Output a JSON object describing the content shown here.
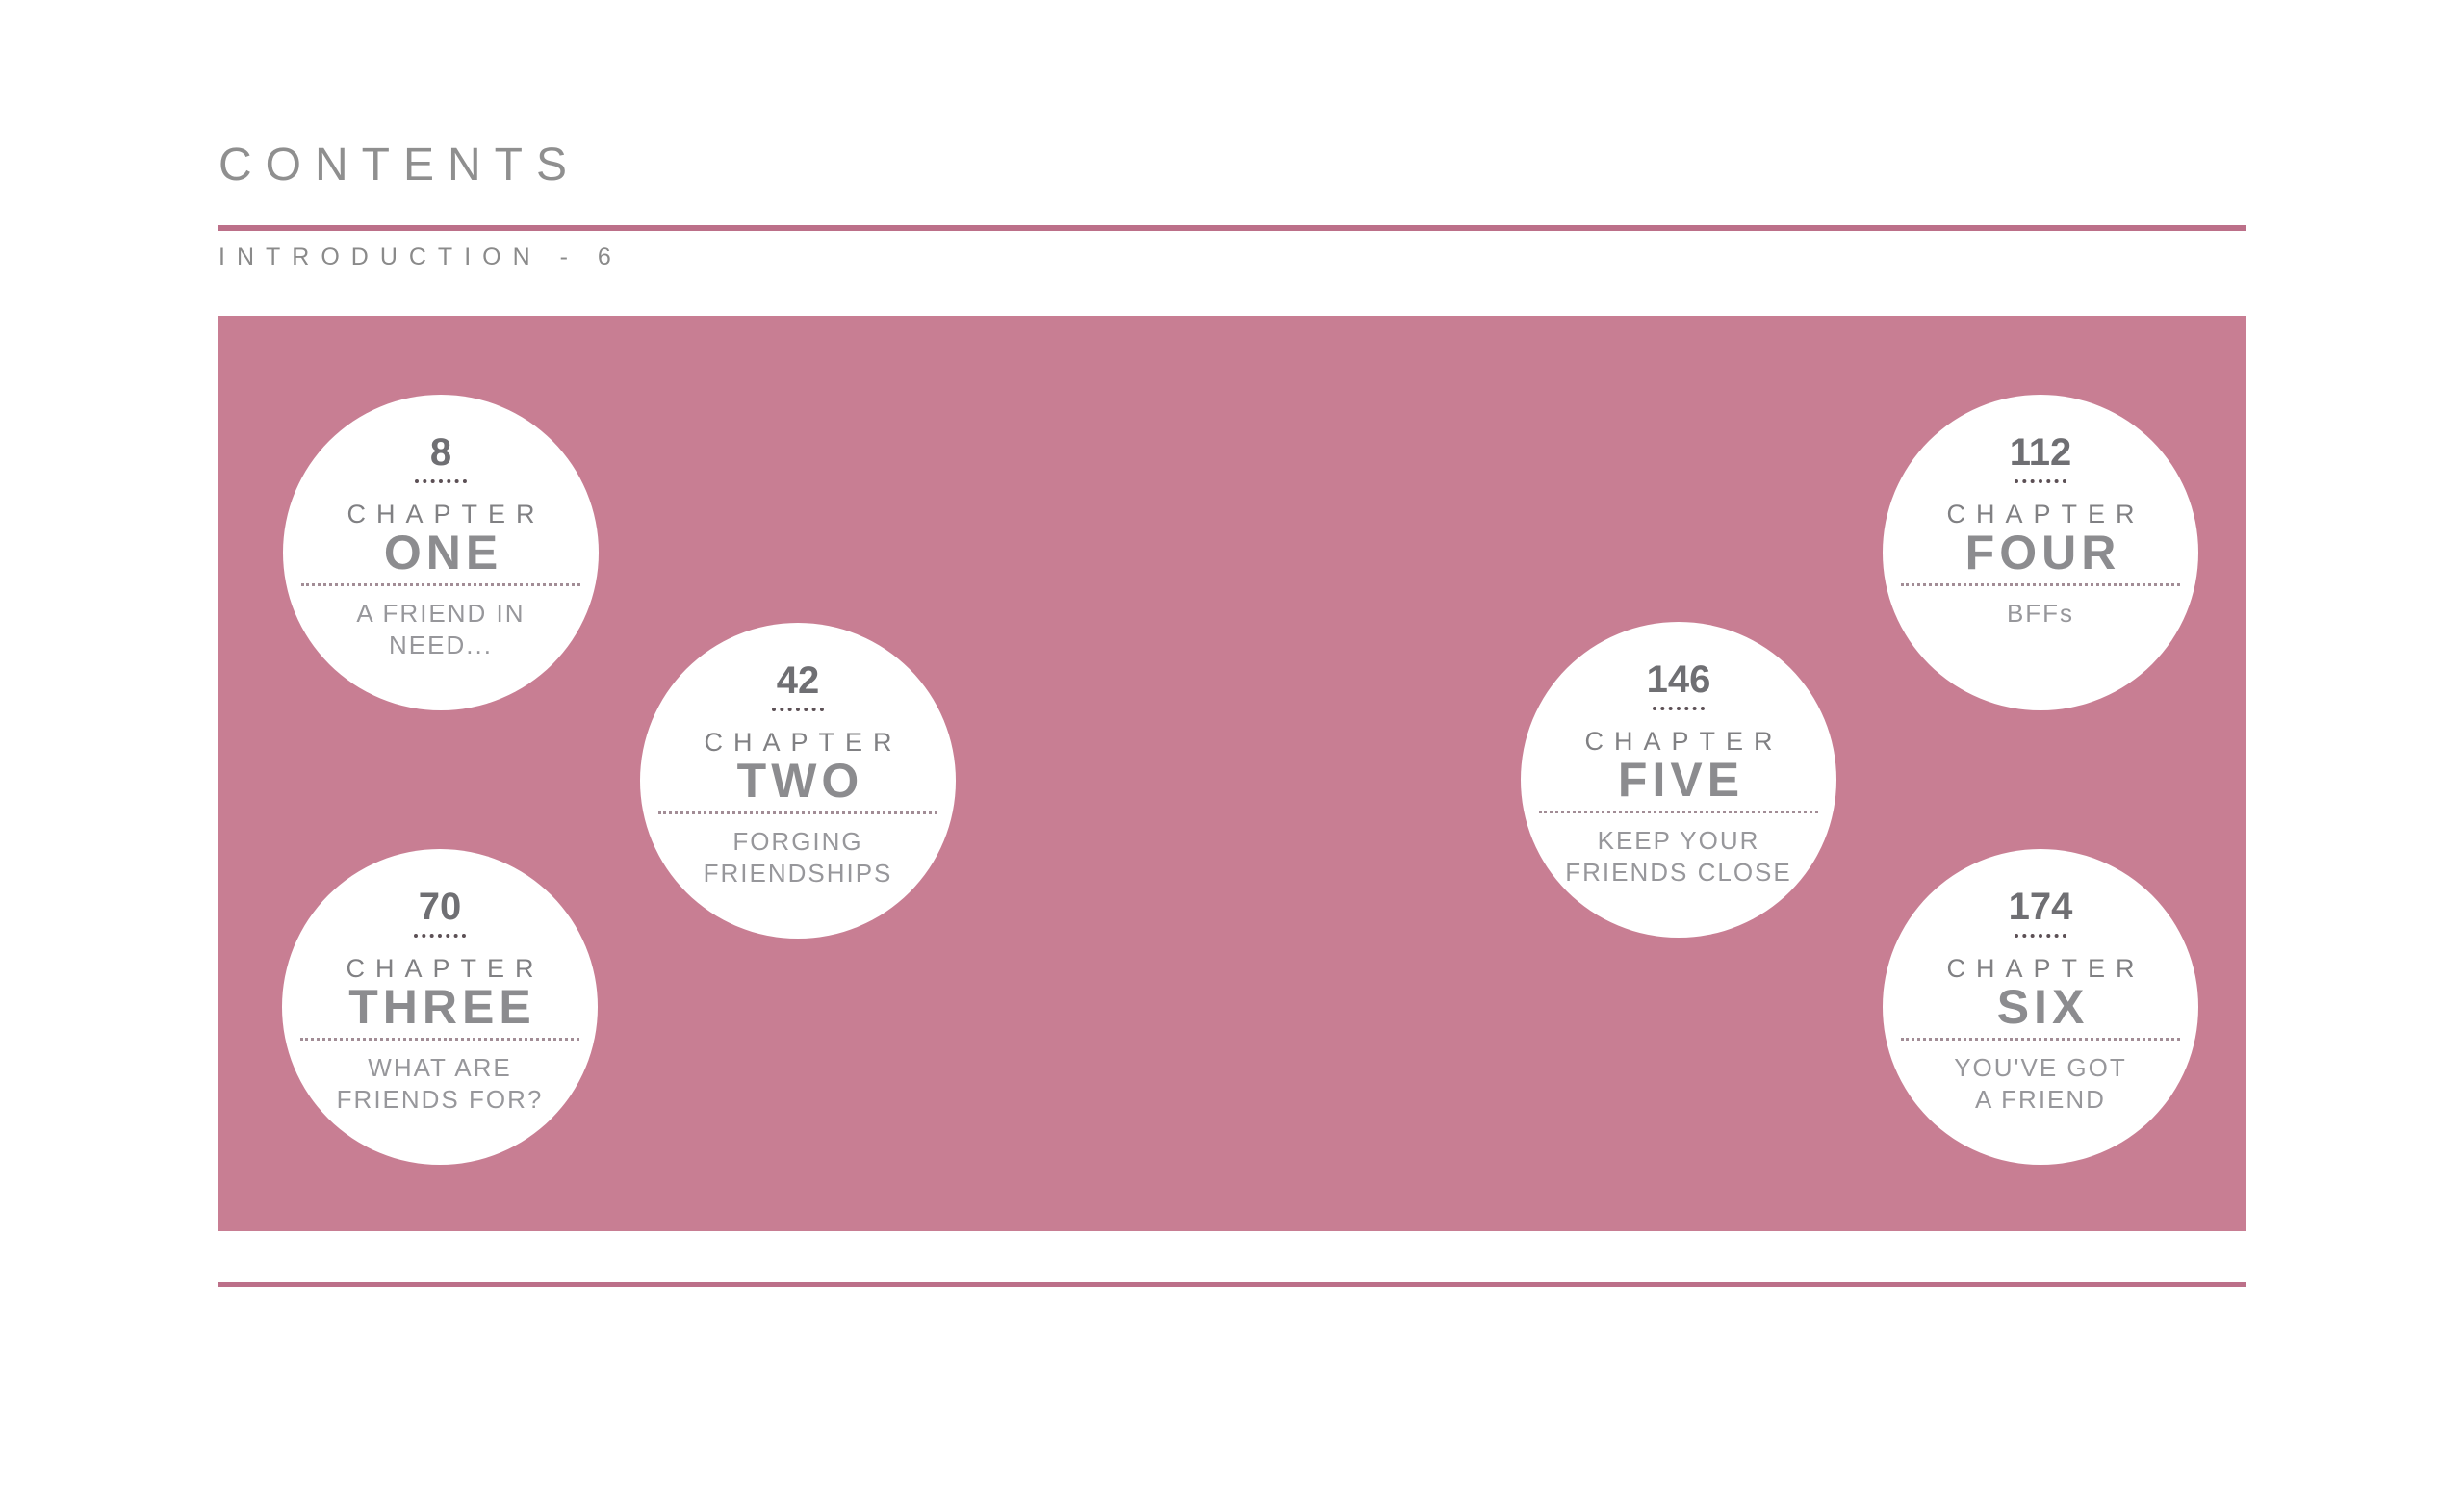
{
  "page": {
    "title": "CONTENTS",
    "introduction": "INTRODUCTION  -  6"
  },
  "chapters": [
    {
      "number": "8",
      "label": "CHAPTER",
      "name": "ONE",
      "subtitle1": "A FRIEND IN",
      "subtitle2": "NEED..."
    },
    {
      "number": "42",
      "label": "CHAPTER",
      "name": "TWO",
      "subtitle1": "FORGING",
      "subtitle2": "FRIENDSHIPS"
    },
    {
      "number": "70",
      "label": "CHAPTER",
      "name": "THREE",
      "subtitle1": "WHAT ARE",
      "subtitle2": "FRIENDS FOR?"
    },
    {
      "number": "112",
      "label": "CHAPTER",
      "name": "FOUR",
      "subtitle1": "BFFs",
      "subtitle2": ""
    },
    {
      "number": "146",
      "label": "CHAPTER",
      "name": "FIVE",
      "subtitle1": "KEEP YOUR",
      "subtitle2": "FRIENDS CLOSE"
    },
    {
      "number": "174",
      "label": "CHAPTER",
      "name": "SIX",
      "subtitle1": "YOU'VE GOT",
      "subtitle2": "A FRIEND"
    }
  ],
  "colors": {
    "background": "#ffffff",
    "band_pink": "#c87e93",
    "rule_pink": "#bc7089",
    "title_gray": "#8f8f8f",
    "chapter_name_gray": "#8c8c8f",
    "subtitle_gray": "#97979b"
  }
}
